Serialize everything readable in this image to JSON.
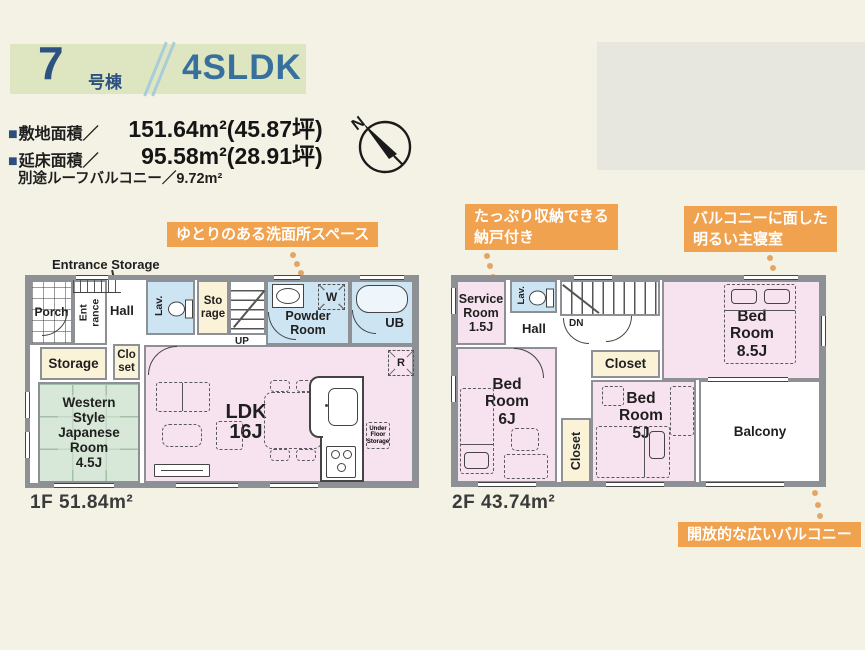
{
  "header": {
    "unit_number": "7",
    "unit_suffix": "号棟",
    "plan_type": "4SLDK"
  },
  "areas": {
    "bullet": "■",
    "land_label": "敷地面積／",
    "land_value": "151.64m²(45.87坪)",
    "floor_label": "延床面積／",
    "floor_value": "95.58m²(28.91坪)",
    "roof_balcony": "別途ルーフバルコニー／9.72m²"
  },
  "compass": {
    "north": "N"
  },
  "callouts": {
    "washroom": "ゆとりのある洗面所スペース",
    "storeroom": "たっぷり収納できる\n納戸付き",
    "master": "バルコニーに面した\n明るい主寝室",
    "balcony": "開放的な広いバルコニー"
  },
  "floor1": {
    "caption": "1F 51.84m²",
    "annotation": "Entrance Storage",
    "rooms": {
      "porch": "Porch",
      "entrance": "Ent\nrance",
      "hall": "Hall",
      "lav": "Lav.",
      "storage_small": "Sto\nrage",
      "up": "UP",
      "powder": "Powder\nRoom",
      "ub": "UB",
      "storage": "Storage",
      "closet": "Clo\nset",
      "japanese_room": "Western\nStyle\nJapanese\nRoom\n4.5J",
      "ldk": "LDK\n16J",
      "washer": "W",
      "fridge": "R",
      "under_floor": "Under\nFloor\nStorage"
    }
  },
  "floor2": {
    "caption": "2F 43.74m²",
    "rooms": {
      "service": "Service\nRoom\n1.5J",
      "lav": "Lav.",
      "hall": "Hall",
      "down": "DN",
      "closet_hall": "Closet",
      "master": "Bed\nRoom\n8.5J",
      "bed6": "Bed\nRoom\n6J",
      "closet_mid": "Closet",
      "bed5": "Bed\nRoom\n5J",
      "balcony": "Balcony"
    }
  },
  "colors": {
    "accent_orange": "#f0a24f",
    "header_band_green": "#dde6c1",
    "number_blue": "#2d5180",
    "type_blue": "#38709d",
    "room_pink": "#f7e3ef",
    "room_blue": "#cde4f2",
    "room_cream": "#faf3d8",
    "room_tatami_green": "#d7e8d8",
    "wall_gray": "#8d9196"
  }
}
